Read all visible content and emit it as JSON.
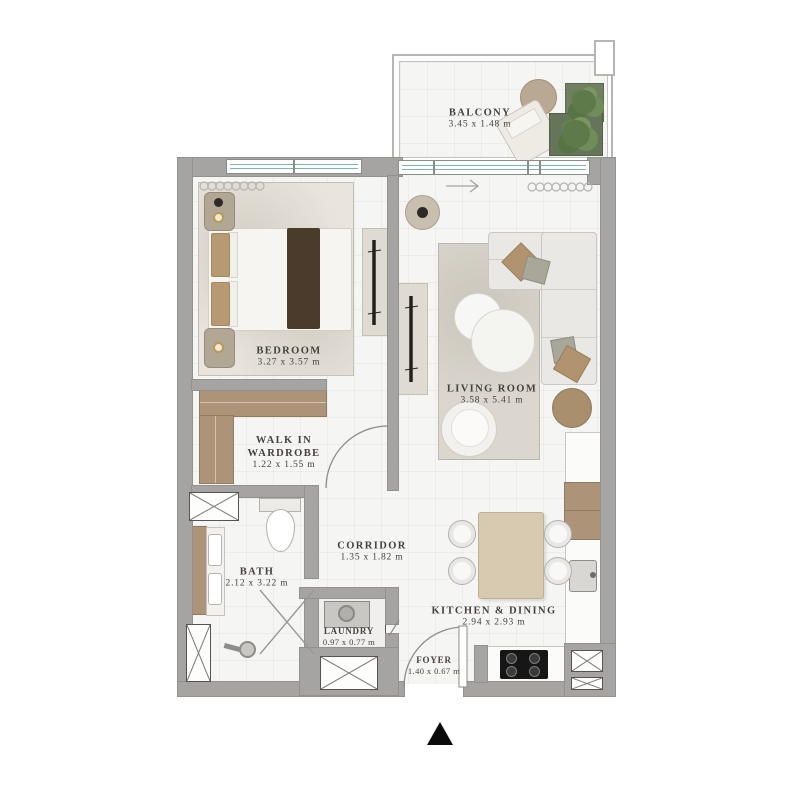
{
  "rooms": {
    "balcony": {
      "name": "BALCONY",
      "dims": "3.45 x 1.48 m"
    },
    "bedroom": {
      "name": "BEDROOM",
      "dims": "3.27 x 3.57 m"
    },
    "living_room": {
      "name": "LIVING ROOM",
      "dims": "3.58 x 5.41 m"
    },
    "walk_in_wardrobe": {
      "name_line1": "WALK IN",
      "name_line2": "WARDROBE",
      "dims": "1.22 x 1.55 m"
    },
    "corridor": {
      "name": "CORRIDOR",
      "dims": "1.35 x 1.82 m"
    },
    "bath": {
      "name": "BATH",
      "dims": "2.12 x 3.22 m"
    },
    "laundry": {
      "name": "LAUNDRY",
      "dims": "0.97 x 0.77 m"
    },
    "kitchen_dining": {
      "name": "KITCHEN & DINING",
      "dims": "2.94 x 2.93 m"
    },
    "foyer": {
      "name": "FOYER",
      "dims": "1.40 x 0.67 m"
    }
  },
  "colors": {
    "wall": "#a5a4a2",
    "floor": "#f5f5f3",
    "wood": "#ad9478",
    "window_glass": "#7fb3ae",
    "rug_bedroom": "#e9e5de",
    "rug_living": "#dbd7cf",
    "plant_green": "#5e7a4b",
    "cooktop_black": "#161616",
    "label_text": "#45423e",
    "entrance_marker": "#0b0b0b"
  }
}
